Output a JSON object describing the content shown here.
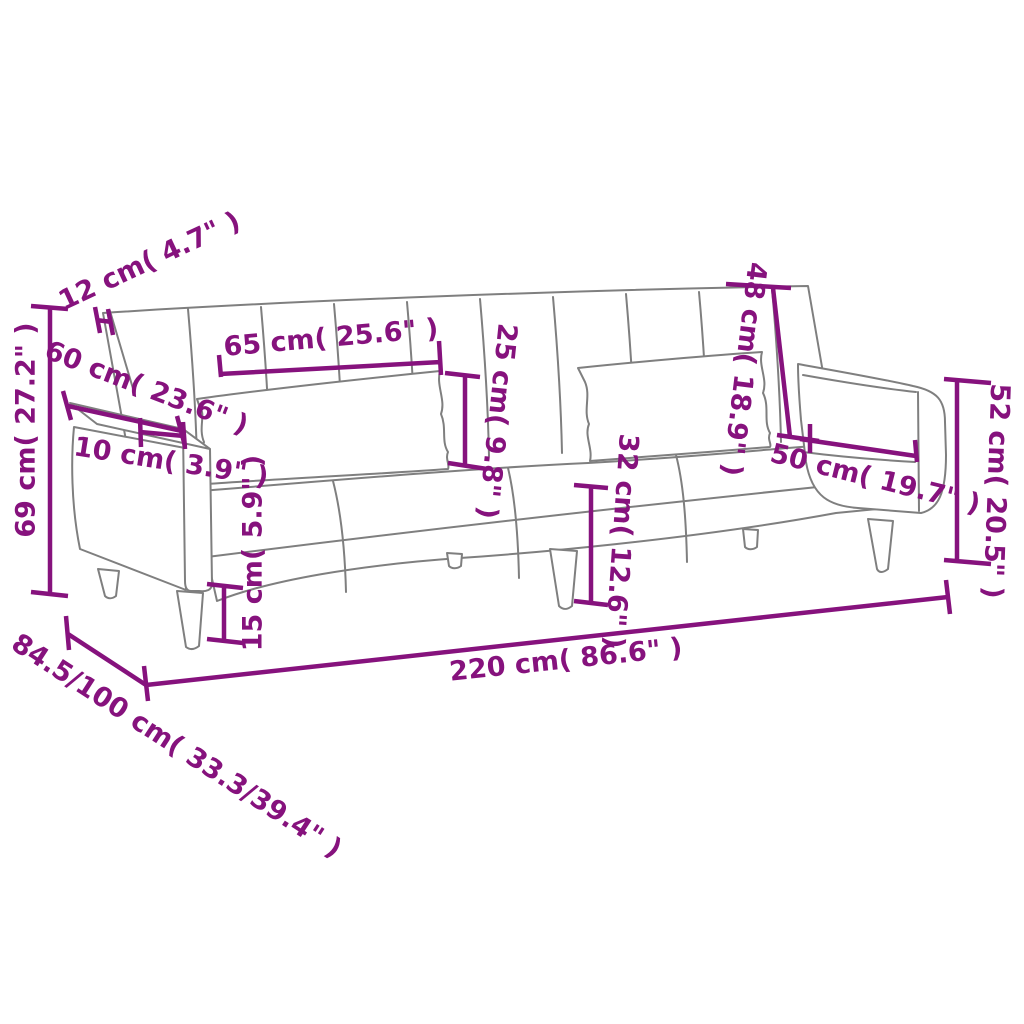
{
  "diagram": {
    "description": "Line-art dimension diagram of a two-seater fabric sofa bed with two lumbar pillows, box armrests and tapered wooden legs, annotated with purple measurement lines",
    "colors": {
      "dimension_lines": "#86127d",
      "sofa_outline": "#7f7f7f",
      "background": "#ffffff"
    },
    "dimensions": [
      {
        "name": "back-cushion-thickness",
        "label": "12 cm( 4.7\" )"
      },
      {
        "name": "total-height",
        "label": "69 cm( 27.2\" )"
      },
      {
        "name": "armrest-length",
        "label": "60 cm( 23.6\" )"
      },
      {
        "name": "armrest-width",
        "label": "10 cm( 3.9\" )"
      },
      {
        "name": "pillow-length",
        "label": "65 cm( 25.6\" )"
      },
      {
        "name": "pillow-height",
        "label": "25 cm( 9.8\" )"
      },
      {
        "name": "backrest-height",
        "label": "48 cm( 18.9\" )"
      },
      {
        "name": "right-armrest-length",
        "label": "50 cm( 19.7\" )"
      },
      {
        "name": "armrest-height",
        "label": "52 cm( 20.5\" )"
      },
      {
        "name": "seat-height",
        "label": "32 cm( 12.6\" )"
      },
      {
        "name": "leg-height",
        "label": "15 cm( 5.9\" )"
      },
      {
        "name": "total-width",
        "label": "220 cm( 86.6\" )"
      },
      {
        "name": "total-depth",
        "label": "84.5/100 cm( 33.3/39.4\" )"
      }
    ]
  }
}
